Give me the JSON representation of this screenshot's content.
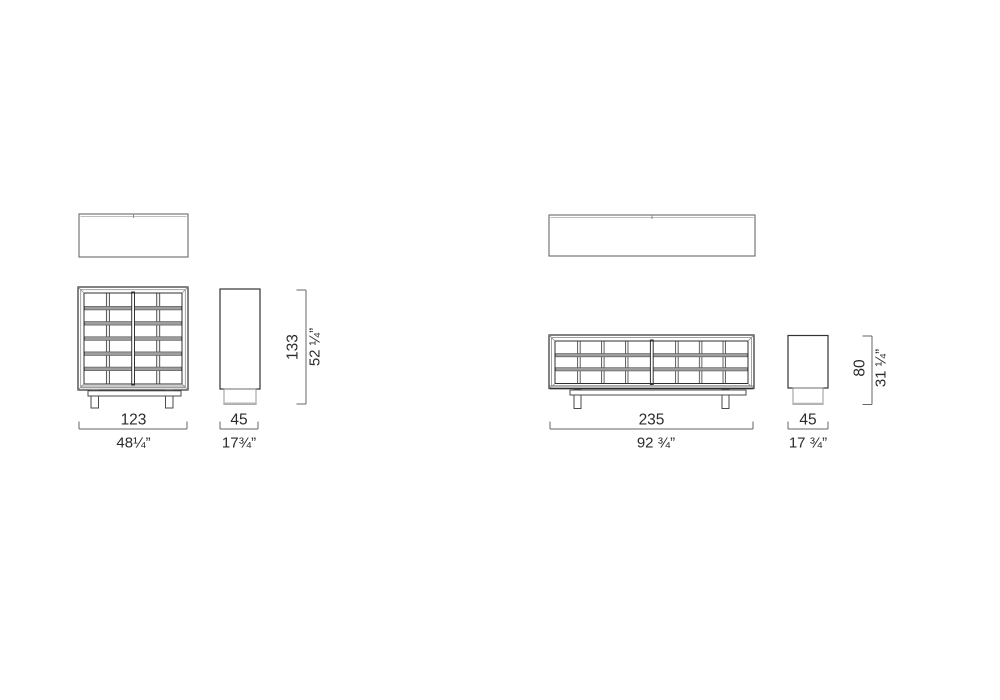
{
  "drawing": {
    "kind": "furniture technical dimension drawing",
    "colors": {
      "outline": "#2f2f2f",
      "frame_light": "#8a8a8a",
      "grid_bar_fill": "#9e9e9e",
      "plinth_shadow": "#c8c8c8",
      "dimension_line": "#666666",
      "text": "#2b2b2b"
    }
  },
  "products": [
    {
      "id": "tall-cabinet",
      "width_cm": "123",
      "width_in": "48¼”",
      "depth_cm": "45",
      "depth_in": "17¾”",
      "height_cm": "133",
      "height_in": "52 ¼”"
    },
    {
      "id": "sideboard",
      "width_cm": "235",
      "width_in": "92 ¾”",
      "depth_cm": "45",
      "depth_in": "17 ¾”",
      "height_cm": "80",
      "height_in": "31 ¼”"
    }
  ]
}
